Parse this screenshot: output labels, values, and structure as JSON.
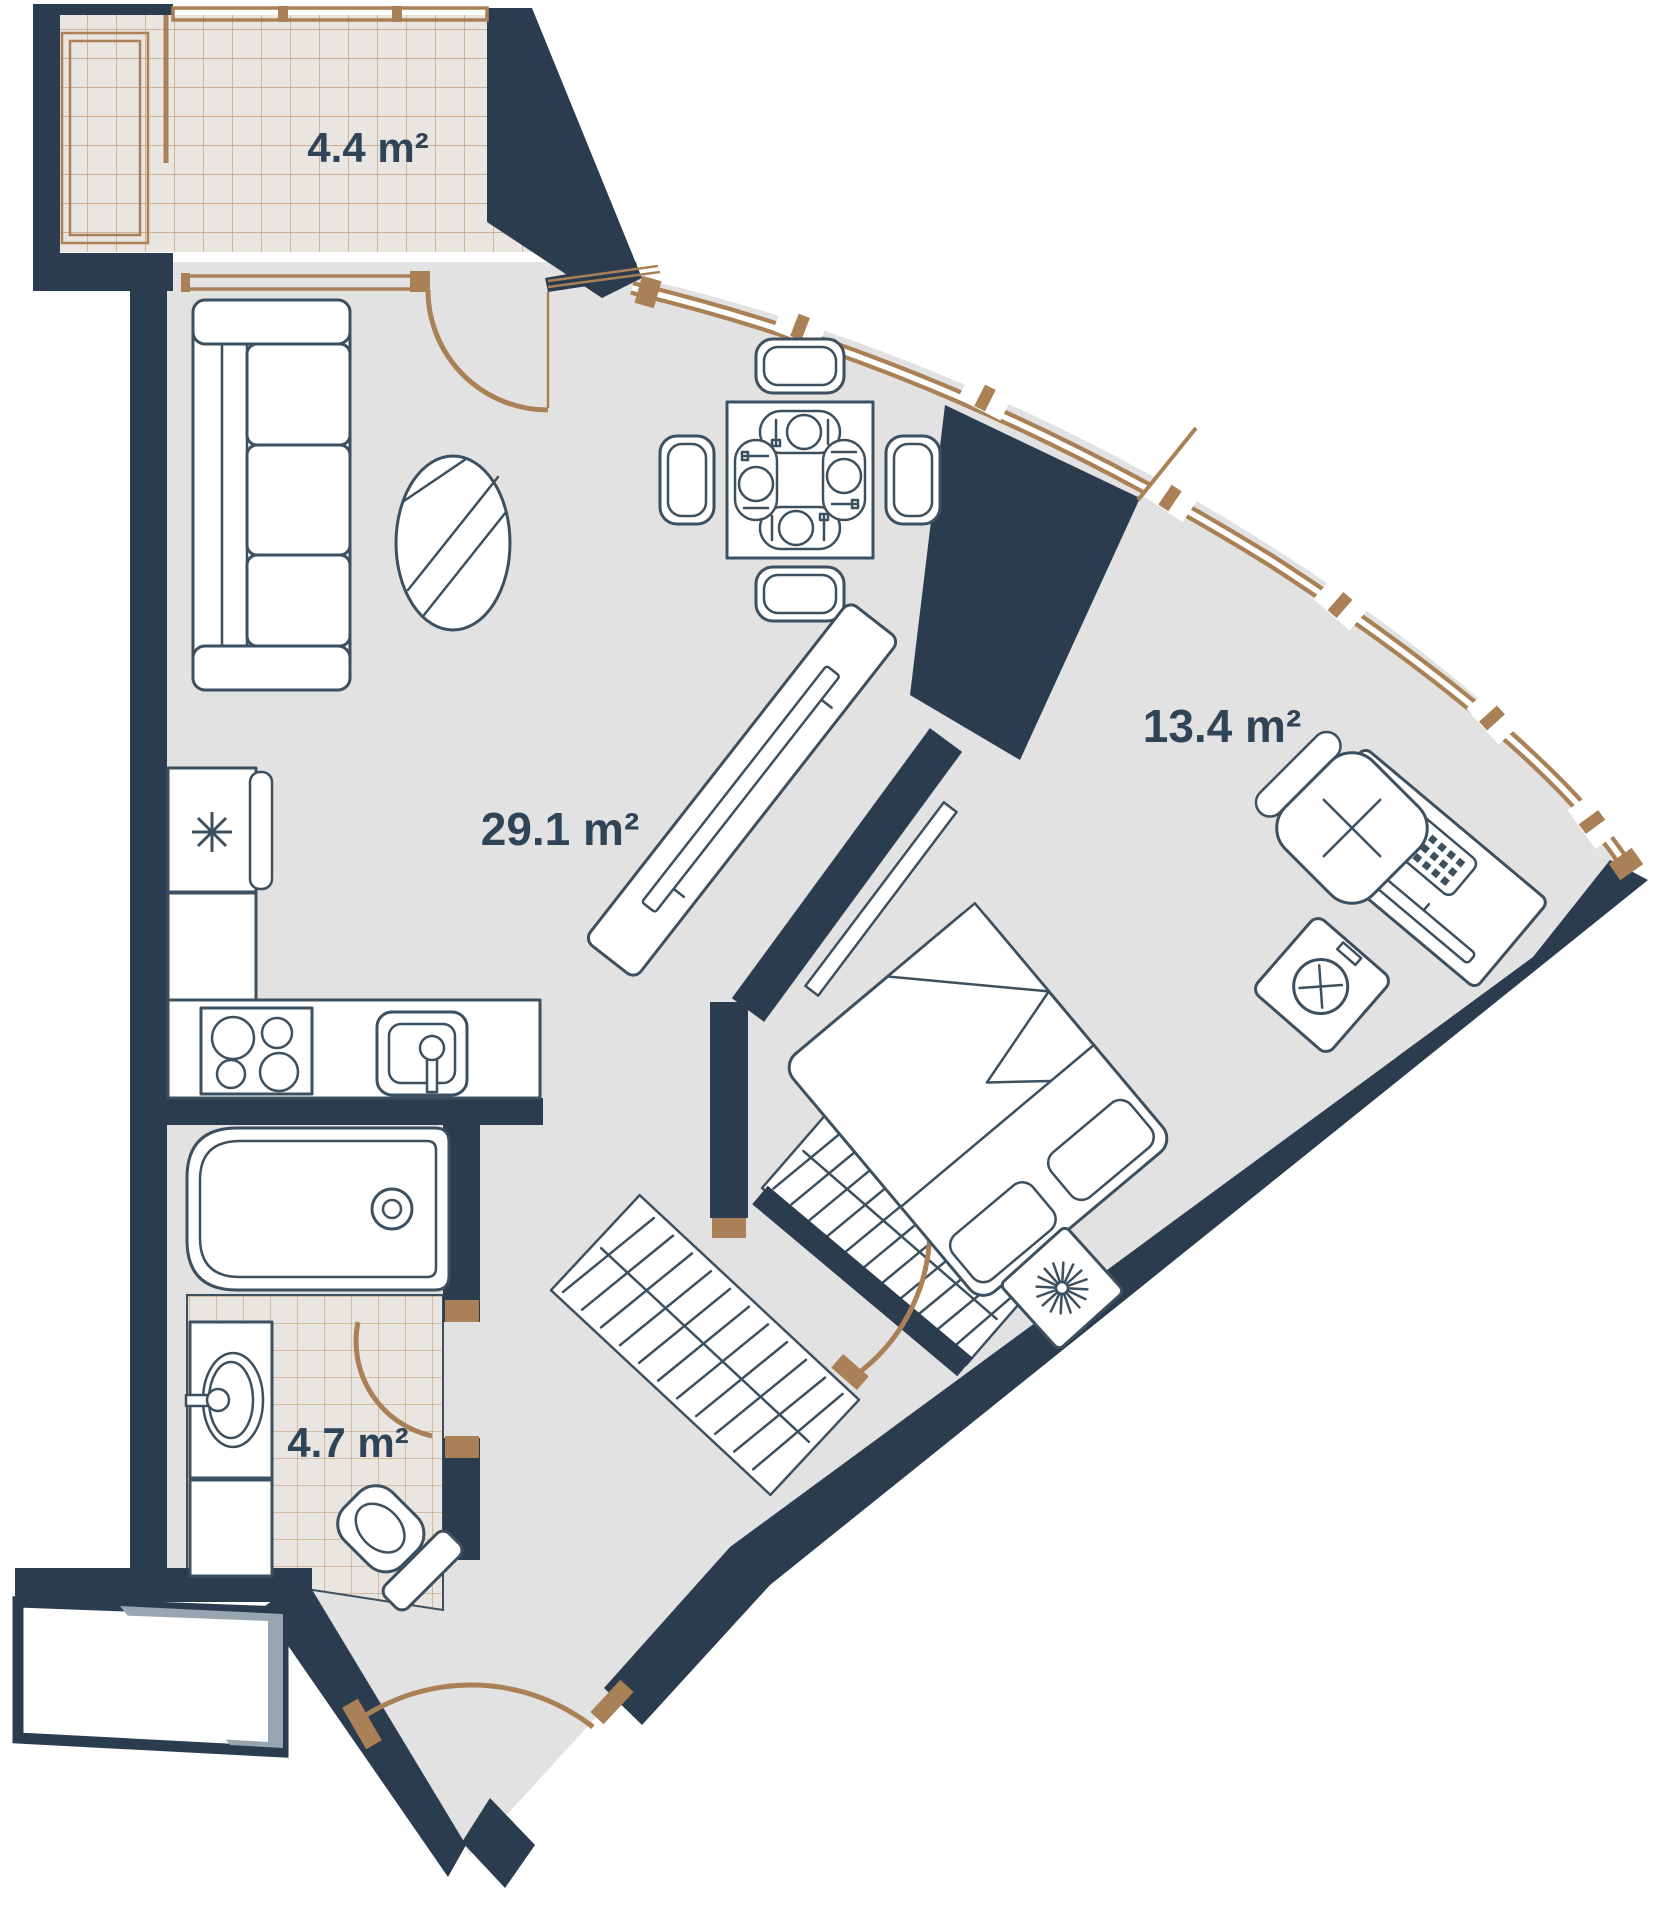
{
  "plan": {
    "type": "apartment-floor-plan",
    "rooms": [
      {
        "name": "balcony",
        "label": "4.4 m²"
      },
      {
        "name": "living-room-kitchen",
        "label": "29.1 m²"
      },
      {
        "name": "bedroom",
        "label": "13.4 m²"
      },
      {
        "name": "bathroom",
        "label": "4.7 m²"
      }
    ],
    "colors": {
      "wall": "#2a3c4d",
      "line": "#3d5060",
      "accent": "#aa8157",
      "floor": "#e2e2e3",
      "tile-bg": "#e9e5e1",
      "tile-line": "#bb9268",
      "label": "#2f4456",
      "shadow": "#97a6b1"
    },
    "icons": [
      "sofa-icon",
      "coffee-table-icon",
      "dining-table-icon",
      "dining-chair-icon",
      "place-setting-icon",
      "refrigerator-icon",
      "snowflake-icon",
      "kitchen-counter-icon",
      "stove-icon",
      "kitchen-sink-icon",
      "tv-console-icon",
      "tv-icon",
      "shelf-icon",
      "bed-icon",
      "pillow-icon",
      "blanket-icon",
      "nightstand-icon",
      "plant-icon",
      "washing-machine-icon",
      "desk-icon",
      "desk-chair-icon",
      "keyboard-icon",
      "mouse-icon",
      "monitor-icon",
      "wardrobe-icon",
      "bathtub-icon",
      "washbasin-icon",
      "toilet-icon",
      "door-swing-icon",
      "window-icon",
      "entrance-landing-icon"
    ]
  }
}
